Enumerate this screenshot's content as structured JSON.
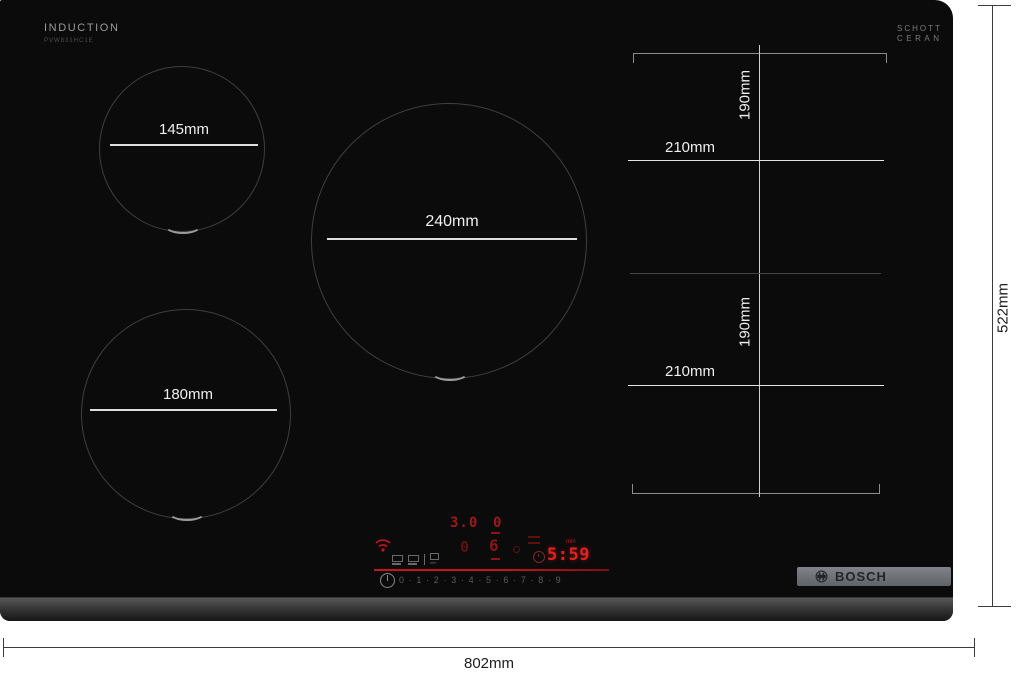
{
  "product": {
    "type_label": "INDUCTION",
    "model_code": "PVW831HC1E",
    "glass_brand_line1": "SCHOTT",
    "glass_brand_line2": "CERAN",
    "brand": "BOSCH"
  },
  "zones": {
    "zone_small_diameter": "145mm",
    "zone_large_diameter": "240mm",
    "zone_medium_diameter": "180mm",
    "flex_upper_height": "190mm",
    "flex_upper_width": "210mm",
    "flex_lower_height": "190mm",
    "flex_lower_width": "210mm"
  },
  "outer_dimensions": {
    "width": "802mm",
    "depth": "522mm"
  },
  "control_panel": {
    "display_row1_left": "3.0",
    "display_row1_right": "0",
    "display_row2_left": "0",
    "display_row2_right": "6",
    "timer_value": "5:59",
    "timer_unit": "min",
    "power_levels": [
      "0",
      "1",
      "2",
      "3",
      "4",
      "5",
      "6",
      "7",
      "8",
      "9"
    ],
    "colors": {
      "led_bright": "#e0231e",
      "led_mid": "#9c1b16",
      "led_dim": "#5f1210",
      "panel_line": "#b0121a"
    }
  },
  "icons": [
    "wifi-icon",
    "clock-icon",
    "power-icon",
    "flex-select-icons",
    "bosch-armature-icon"
  ]
}
